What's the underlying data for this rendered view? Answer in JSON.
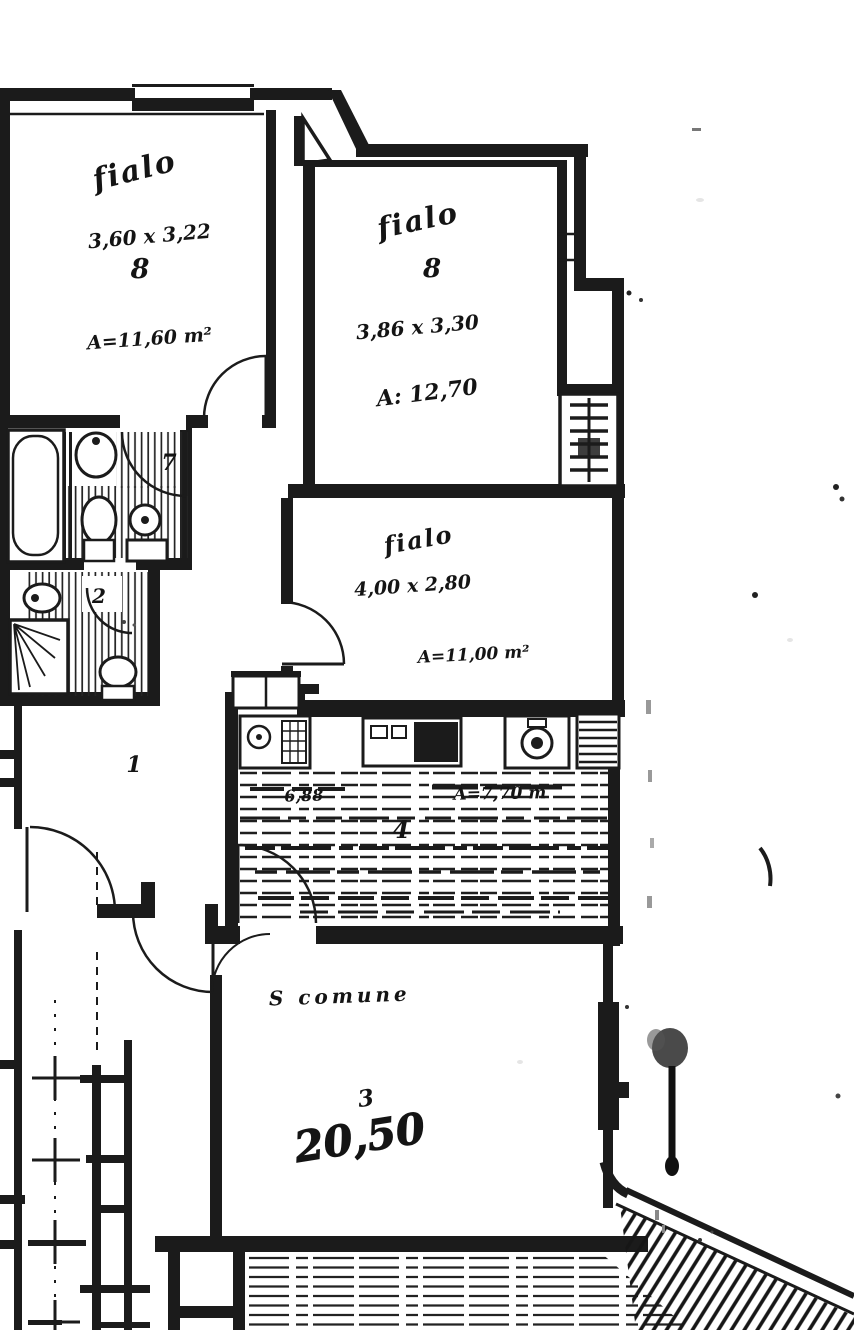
{
  "plan": {
    "paper_color": "#ffffff",
    "ink_color": "#1b1b1b",
    "bedroom1": {
      "scribble": "fialo",
      "dims": "3,60 x 3,22",
      "number": "8",
      "area": "A=11,60 m²"
    },
    "bedroom2": {
      "scribble": "fialo",
      "number": "8",
      "dims": "3,86 x 3,30",
      "area": "A: 12,70"
    },
    "bedroom3": {
      "scribble": "fialo",
      "dims": "4,00 x 2,80",
      "area": "A=11,00 m²"
    },
    "kitchen": {
      "number": "4",
      "value_left": "6,88",
      "area_scribble": "A=7,70 m"
    },
    "living": {
      "name": "S comune",
      "number": "3",
      "area": "20,50"
    },
    "hallway": {
      "number": "1"
    },
    "bathroom_main": {
      "number": "7"
    },
    "bathroom_small": {
      "number": "2"
    }
  }
}
